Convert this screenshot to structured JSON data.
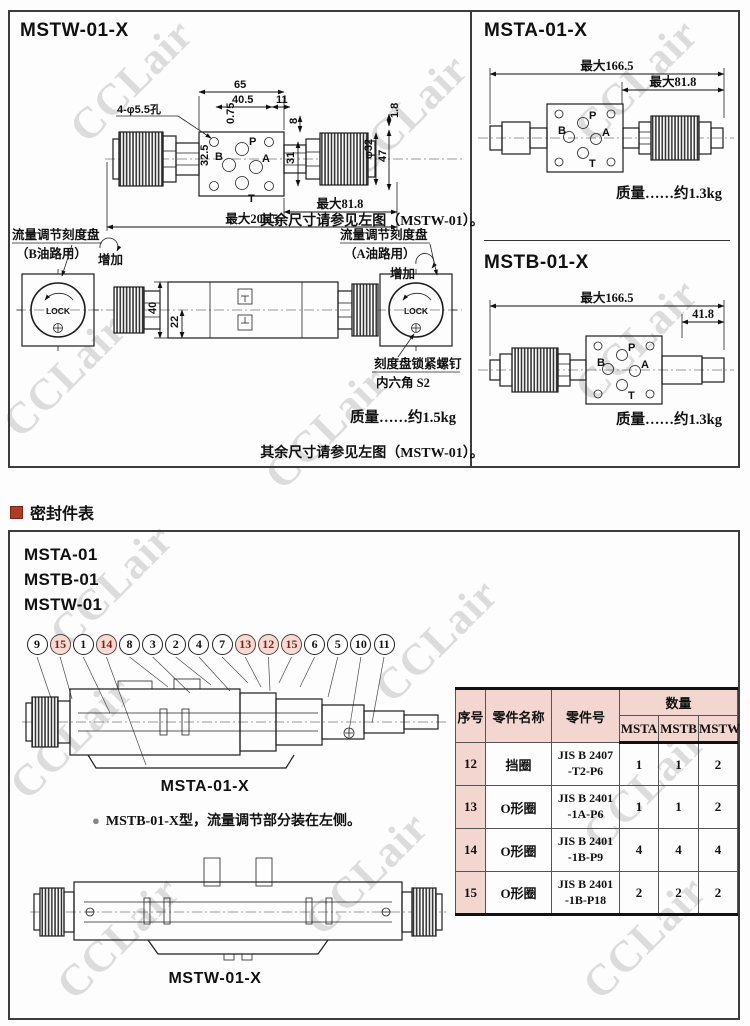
{
  "watermark": {
    "text": "CCLair",
    "color": "#dcdcdc"
  },
  "colors": {
    "accent_red": "#b03a2a",
    "table_header_bg": "#f3d6cf",
    "balloon_highlight_bg": "#f6dbd4"
  },
  "panel_mstw": {
    "title": "MSTW-01-X",
    "dims": {
      "holes": "4-φ5.5孔",
      "w65": "65",
      "w40_5": "40.5",
      "w11": "11",
      "h0_75": "0.75",
      "h8": "8",
      "h1_8": "1.8",
      "h32_5": "32.5",
      "h31": "31",
      "dia32": "φ32",
      "h47": "47",
      "max81_8": "最大81.8",
      "max206_5": "最大206.5",
      "h40": "40",
      "h22": "22"
    },
    "ports": {
      "p": "P",
      "a": "A",
      "b": "B",
      "t": "T"
    },
    "dial_b": {
      "line1": "流量调节刻度盘",
      "line2": "（B油路用）",
      "increase": "增加",
      "lock": "LOCK"
    },
    "dial_a": {
      "line1": "流量调节刻度盘",
      "line2": "（A油路用）",
      "increase": "增加",
      "lock": "LOCK"
    },
    "screw_note": {
      "line1": "刻度盘锁紧螺钉",
      "line2": "内六角 S2"
    },
    "weight": "质量……约1.5kg"
  },
  "panel_msta": {
    "title": "MSTA-01-X",
    "dims": {
      "max166_5": "最大166.5",
      "max81_8": "最大81.8"
    },
    "ports": {
      "p": "P",
      "a": "A",
      "b": "B",
      "t": "T"
    },
    "weight": "质量……约1.3kg",
    "note": "其余尺寸请参见左图（MSTW-01）。"
  },
  "panel_mstb": {
    "title": "MSTB-01-X",
    "dims": {
      "max166_5": "最大166.5",
      "w41_8": "41.8"
    },
    "ports": {
      "p": "P",
      "a": "A",
      "b": "B",
      "t": "T"
    },
    "weight": "质量……约1.3kg",
    "note": "其余尺寸请参见左图（MSTW-01）。"
  },
  "seal": {
    "heading": "密封件表",
    "models": [
      "MSTA-01",
      "MSTB-01",
      "MSTW-01"
    ],
    "balloons": [
      {
        "n": "9",
        "hl": false
      },
      {
        "n": "15",
        "hl": true
      },
      {
        "n": "1",
        "hl": false
      },
      {
        "n": "14",
        "hl": true
      },
      {
        "n": "8",
        "hl": false
      },
      {
        "n": "3",
        "hl": false
      },
      {
        "n": "2",
        "hl": false
      },
      {
        "n": "4",
        "hl": false
      },
      {
        "n": "7",
        "hl": false
      },
      {
        "n": "13",
        "hl": true
      },
      {
        "n": "12",
        "hl": true
      },
      {
        "n": "15",
        "hl": true
      },
      {
        "n": "6",
        "hl": false
      },
      {
        "n": "5",
        "hl": false
      },
      {
        "n": "10",
        "hl": false
      },
      {
        "n": "11",
        "hl": false
      }
    ],
    "label_msta": "MSTA-01-X",
    "bullet": "●",
    "note": "MSTB-01-X型，流量调节部分装在左侧。",
    "label_mstw": "MSTW-01-X",
    "table": {
      "col_index": "序号",
      "col_name": "零件名称",
      "col_part": "零件号",
      "col_qty": "数量",
      "qty_cols": [
        "MSTA",
        "MSTB",
        "MSTW"
      ],
      "rows": [
        {
          "no": "12",
          "name": "挡圈",
          "part": "JIS B 2407\n-T2-P6",
          "q0": "1",
          "q1": "1",
          "q2": "2"
        },
        {
          "no": "13",
          "name": "O形圈",
          "part": "JIS B 2401\n-1A-P6",
          "q0": "1",
          "q1": "1",
          "q2": "2"
        },
        {
          "no": "14",
          "name": "O形圈",
          "part": "JIS B 2401\n-1B-P9",
          "q0": "4",
          "q1": "4",
          "q2": "4"
        },
        {
          "no": "15",
          "name": "O形圈",
          "part": "JIS B 2401\n-1B-P18",
          "q0": "2",
          "q1": "2",
          "q2": "2"
        }
      ]
    }
  }
}
